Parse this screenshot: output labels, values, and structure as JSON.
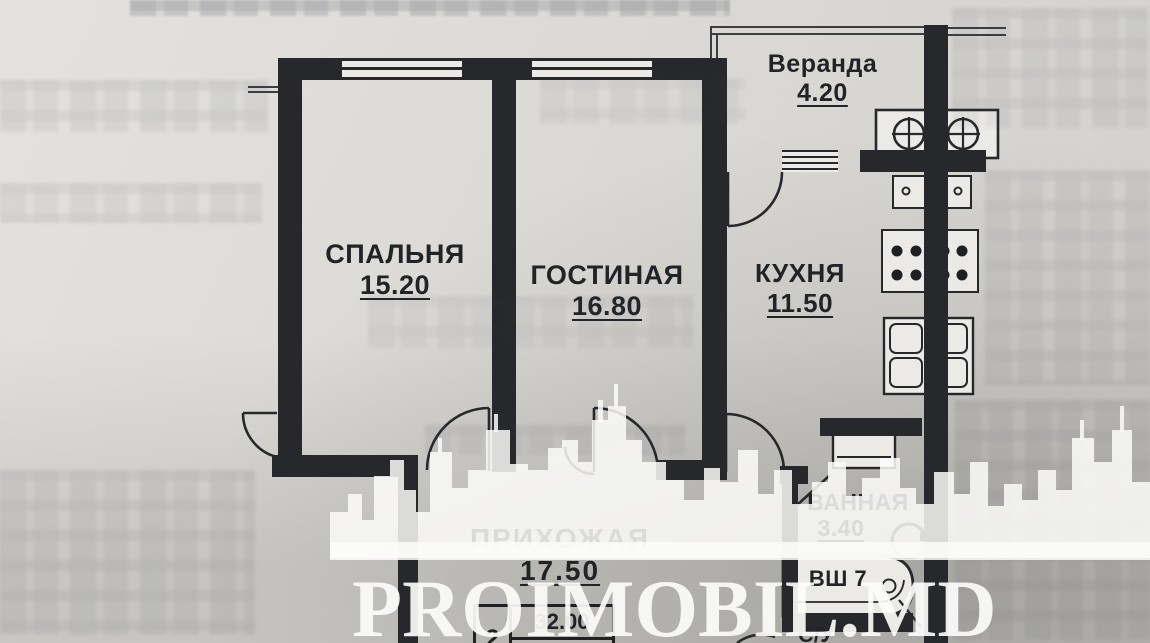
{
  "plan_title": "apartment floor plan (2-room)",
  "rooms": {
    "veranda": {
      "name": "Веранда",
      "area": "4.20"
    },
    "bedroom": {
      "name": "СПАЛЬНЯ",
      "area": "15.20"
    },
    "living": {
      "name": "ГОСТИНАЯ",
      "area": "16.80"
    },
    "kitchen": {
      "name": "КУХНЯ",
      "area": "11.50"
    },
    "bath": {
      "name": "ВАННАЯ",
      "area": "3.40"
    },
    "hall": {
      "name": "ПРИХОЖАЯ",
      "area": "17.50"
    }
  },
  "labels": {
    "shaft": "ВШ 7",
    "wc": "С/У"
  },
  "summary_table": {
    "rooms_count": "2",
    "living_area": "32.00",
    "total_area": "62.60"
  },
  "watermark": {
    "brand": "PROIMOBIL.MD"
  },
  "colors": {
    "paper": "#dcdad6",
    "wall": "#26282b",
    "ink": "#212427",
    "watermark": "#fbfbf9"
  }
}
